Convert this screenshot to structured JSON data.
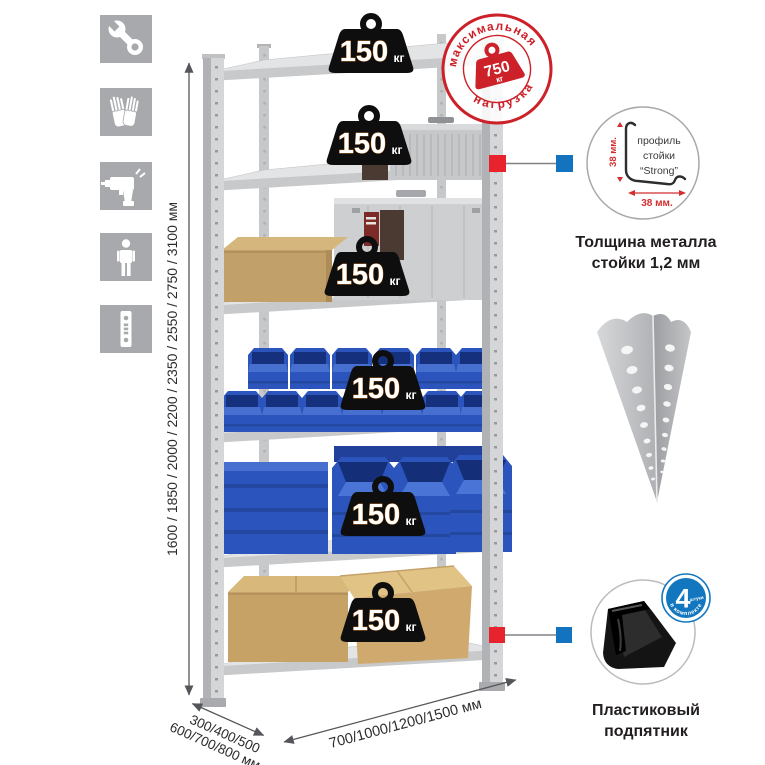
{
  "colors": {
    "accent_red": "#cd2129",
    "marker_red": "#e8232e",
    "marker_blue": "#1373bf",
    "badge_blue": "#1377c0",
    "bin_blue": "#2b55bc",
    "icon_tile_gray": "#a7a9ac",
    "metal_gray": "#d4d6d8",
    "cardboard": "#c6a267"
  },
  "sidebar": {
    "icons": [
      "wrench",
      "gloves",
      "drill",
      "person",
      "perforated-profile"
    ]
  },
  "rack": {
    "shelf_count": 6,
    "shelf_load": {
      "value": "150",
      "unit": "кг"
    }
  },
  "max_load_stamp": {
    "arc_top": "максимальная",
    "arc_bottom": "нагрузка",
    "value": "750",
    "unit": "кг"
  },
  "dimensions": {
    "height": "1600 / 1850 / 2000 / 2200 / 2350 / 2550 / 2750 / 3100 мм",
    "depth_line1": "300/400/500",
    "depth_line2": "600/700/800 мм",
    "width": "700/1000/1200/1500 мм"
  },
  "profile_detail": {
    "line1": "профиль",
    "line2": "стойки",
    "line3": "“Strong”",
    "dim_vertical": "38 мм.",
    "dim_horizontal": "38 мм.",
    "caption_line1": "Толщина металла",
    "caption_line2": "стойки 1,2 мм"
  },
  "foot_detail": {
    "badge_value": "4",
    "badge_qty": "штуки",
    "badge_arc": "в комплекте",
    "caption_line1": "Пластиковый",
    "caption_line2": "подпятник"
  }
}
